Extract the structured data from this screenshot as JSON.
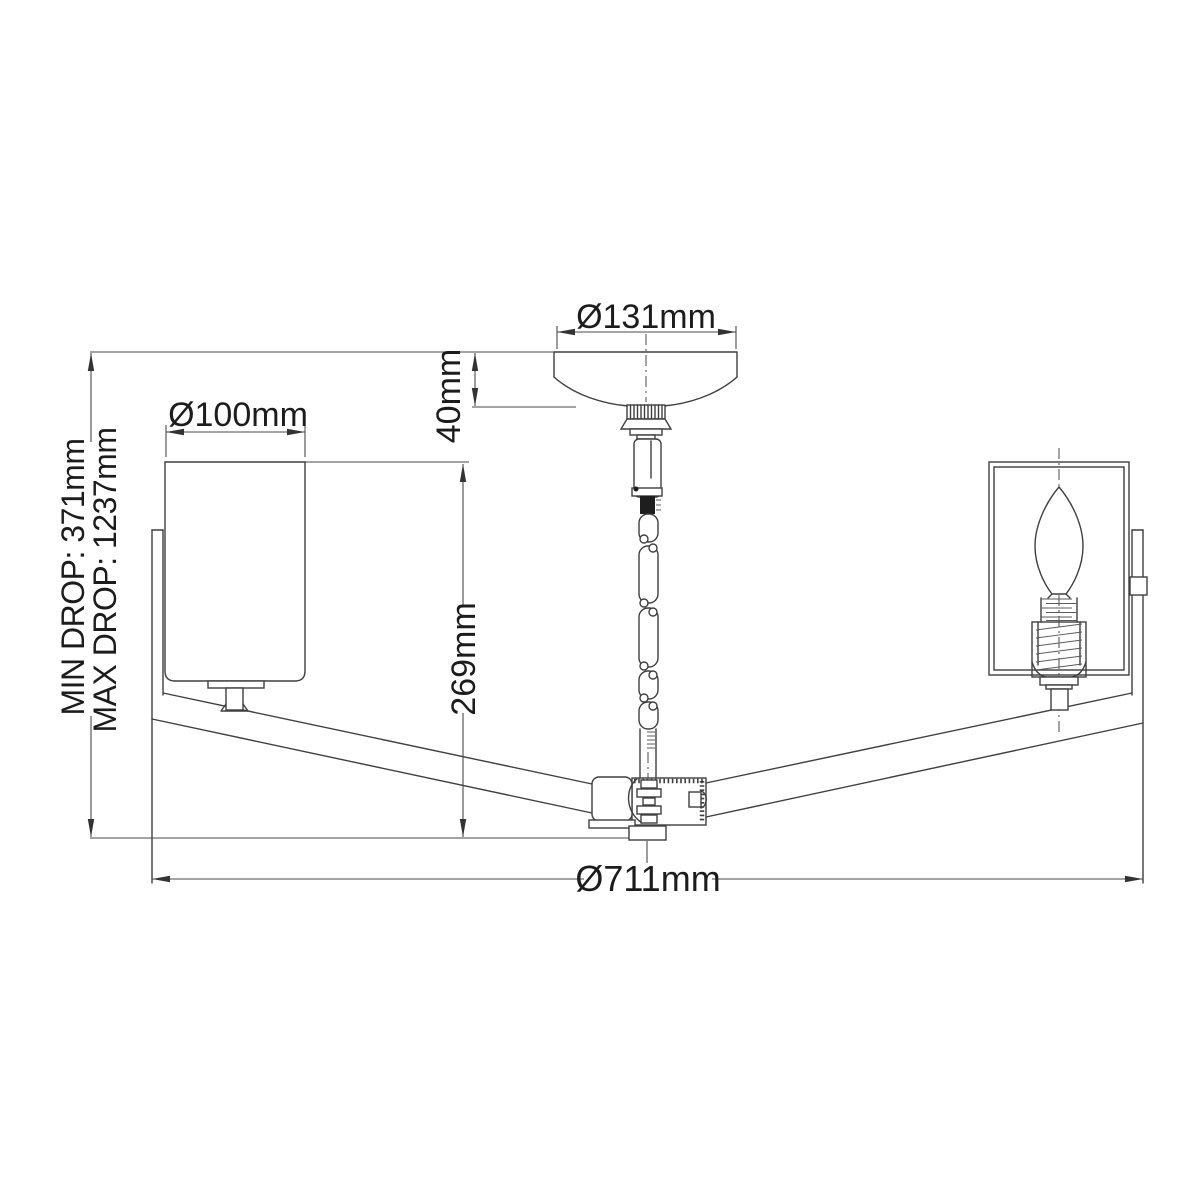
{
  "diagram": {
    "background": "#ffffff",
    "line_color": "#3f3f3f",
    "text_color": "#1c1c1c",
    "labels": {
      "canopy_diameter": "Ø131mm",
      "canopy_height": "40mm",
      "shade_diameter": "Ø100mm",
      "body_height": "269mm",
      "min_drop": "MIN DROP: 371mm",
      "max_drop": "MAX DROP: 1237mm",
      "overall_diameter": "Ø711mm"
    }
  }
}
